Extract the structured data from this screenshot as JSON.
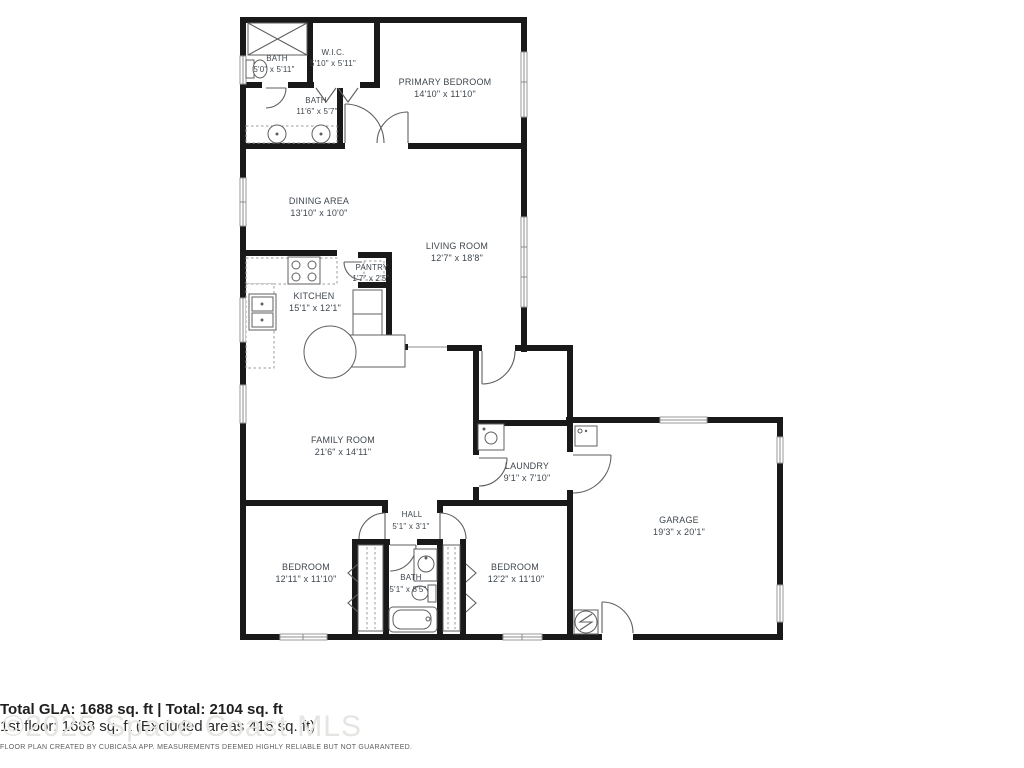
{
  "plan": {
    "rooms": [
      {
        "name": "BATH",
        "dims": "5'0\" x 5'11\""
      },
      {
        "name": "W.I.C.",
        "dims": "5'10\" x 5'11\""
      },
      {
        "name": "PRIMARY BEDROOM",
        "dims": "14'10\" x 11'10\""
      },
      {
        "name": "BATH",
        "dims": "11'6\" x 5'7\""
      },
      {
        "name": "DINING AREA",
        "dims": "13'10\" x 10'0\""
      },
      {
        "name": "LIVING ROOM",
        "dims": "12'7\" x 18'8\""
      },
      {
        "name": "PANTRY",
        "dims": "1'7\" x 2'5\""
      },
      {
        "name": "KITCHEN",
        "dims": "15'1\" x 12'1\""
      },
      {
        "name": "FAMILY ROOM",
        "dims": "21'6\" x 14'11\""
      },
      {
        "name": "LAUNDRY",
        "dims": "9'1\" x 7'10\""
      },
      {
        "name": "HALL",
        "dims": "5'1\" x 3'1\""
      },
      {
        "name": "BEDROOM",
        "dims": "12'11\" x 11'10\""
      },
      {
        "name": "BATH",
        "dims": "5'1\" x 8'5\""
      },
      {
        "name": "BEDROOM",
        "dims": "12'2\" x 11'10\""
      },
      {
        "name": "GARAGE",
        "dims": "19'3\" x 20'1\""
      }
    ],
    "footer": {
      "total_line": "Total GLA: 1688 sq. ft | Total: 2104 sq. ft",
      "floor_line": "1st floor: 1688 sq. ft (Excluded areas 416 sq. ft)",
      "disclaimer": "FLOOR PLAN CREATED BY CUBICASA APP. MEASUREMENTS DEEMED HIGHLY RELIABLE BUT NOT GUARANTEED."
    },
    "watermark": "©2025 Space Coast MLS"
  }
}
